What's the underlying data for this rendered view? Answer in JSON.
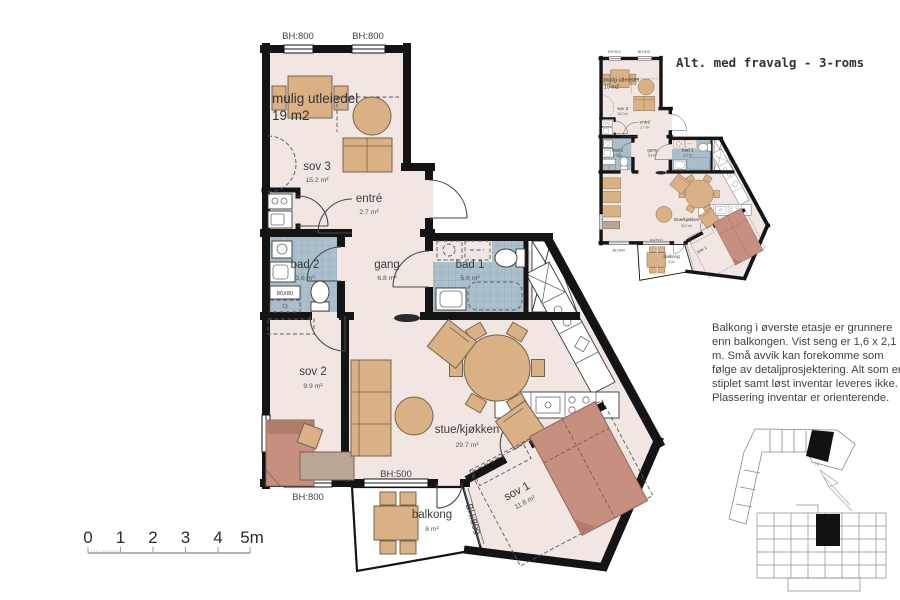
{
  "title": "Alt. med fravalg - 3-roms",
  "colors": {
    "wall": "#141414",
    "floor": "#f1e6e1",
    "bath_tile": "#abc0cb",
    "furniture": "#d9b185",
    "bed": "#c68f7f"
  },
  "main_plan": {
    "rooms": {
      "utleiedel": {
        "name": "mulig utleiedel",
        "area": "19 m2"
      },
      "sov3": {
        "name": "sov 3",
        "area": "15.2 m²"
      },
      "entre": {
        "name": "entré",
        "area": "2.7 m²"
      },
      "bad2": {
        "name": "bad 2",
        "area": "3.6 m²"
      },
      "gang": {
        "name": "gang",
        "area": "6.8 m²"
      },
      "bad1": {
        "name": "bad 1",
        "area": "5.6 m²"
      },
      "sov2": {
        "name": "sov 2",
        "area": "9.9 m²"
      },
      "stue": {
        "name": "stue/kjøkken",
        "area": "29.7 m²"
      },
      "balkong": {
        "name": "balkong",
        "area": "8 m²"
      },
      "sov1": {
        "name": "sov 1",
        "area": "11.8 m²"
      }
    },
    "windows": {
      "top_left": "BH:800",
      "top_right": "BH:800",
      "bottom_left": "BH:800",
      "balcony_top": "BH:500",
      "balcony_side": "BH:800"
    },
    "shower_size": "80X80"
  },
  "alt_plan": {
    "title": "Alt. med fravalg - 3-roms",
    "rooms": {
      "utleiedel": {
        "name": "mulig utleiedel",
        "area": "19 m2"
      },
      "sov3": {
        "name": "sov 3",
        "area": "15.2 m²"
      },
      "entre": {
        "name": "entré",
        "area": "2.7 m²"
      },
      "bad2": {
        "name": "bad 2",
        "area": "3.6 m²"
      },
      "gang": {
        "name": "gang",
        "area": "6.8 m²"
      },
      "bad1": {
        "name": "bad 1",
        "area": "5.6 m²"
      },
      "stue": {
        "name": "stue/kjøkken",
        "area": "40.2 m²"
      },
      "balkong": {
        "name": "balkong",
        "area": "8 m²"
      },
      "sov1": {
        "name": "sov 1",
        "area": "11.8 m²"
      }
    },
    "windows": {
      "top_left": "BH:800",
      "top_right": "BH:800",
      "bottom_left": "BH:800",
      "balcony_top": "BH:500"
    }
  },
  "note": {
    "lines": [
      "Balkong i øverste etasje er grunnere",
      "enn balkongen. Vist seng er 1,6 x 2,1",
      "m. Små avvik kan forekomme som",
      "følge av detaljprosjektering. Alt som er",
      "stiplet samt løst inventar leveres ikke.",
      "Plassering inventar er orienterende."
    ]
  },
  "scale_bar": {
    "labels": [
      "0",
      "1",
      "2",
      "3",
      "4",
      "5m"
    ]
  },
  "north": {
    "label": "N"
  }
}
